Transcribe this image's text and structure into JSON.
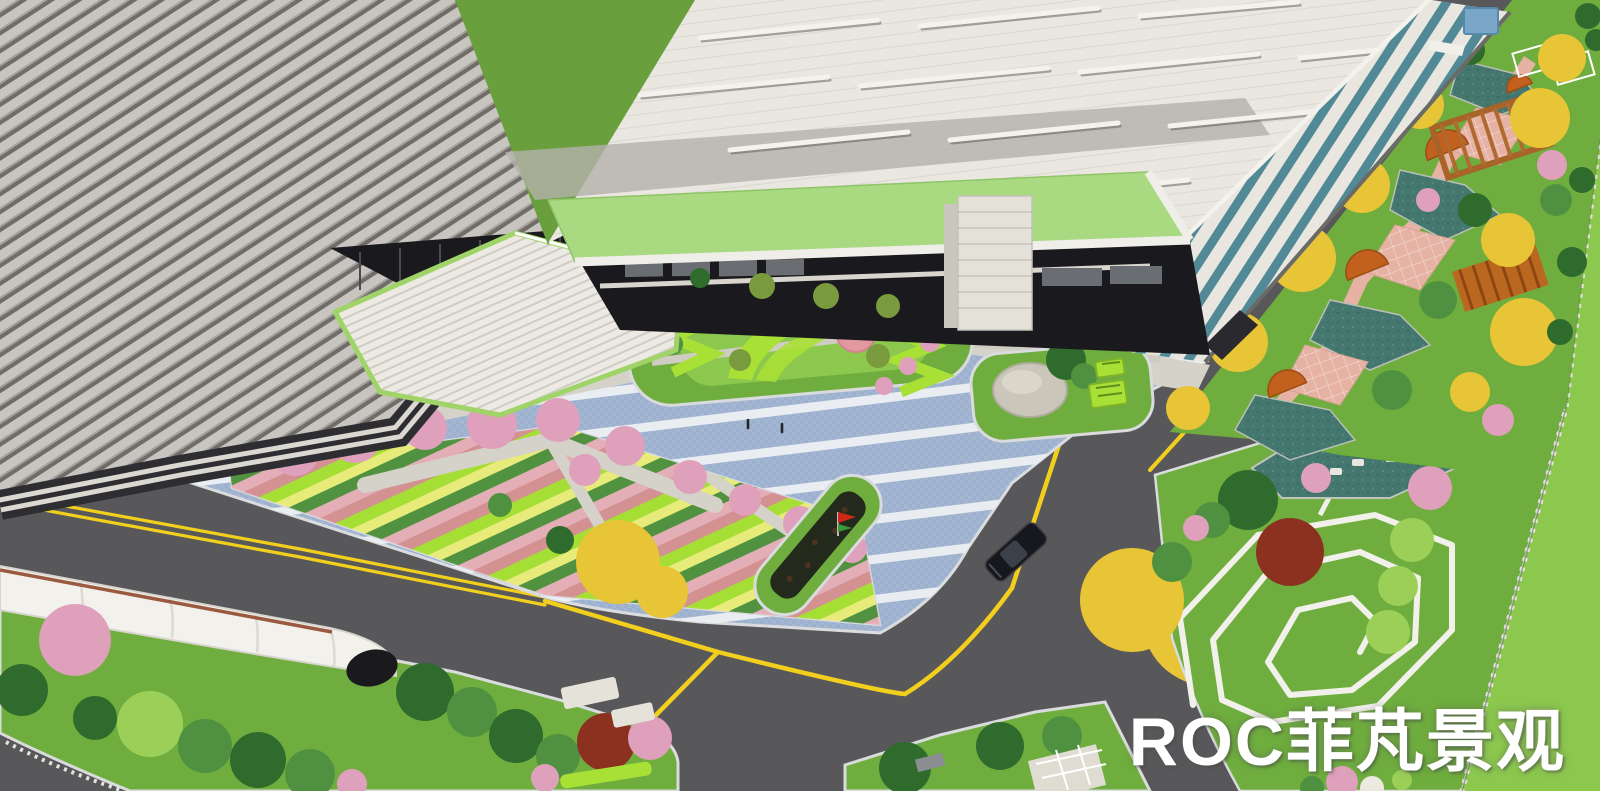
{
  "scene": {
    "type": "aerial-3d-landscape-rendering",
    "subject": "factory campus landscape design rendering with warehouses, entrance plaza, parking lot, roads and linear gardens"
  },
  "watermark": {
    "text": "ROC菲芃景观"
  },
  "palette": {
    "asphalt": "#58585b",
    "roadline": "#f2cf1d",
    "curb": "#d9dbdd",
    "paving": "#9db1cf",
    "paving_stripe": "#eef1f4",
    "walk_light": "#d5d2c9",
    "walk_stone": "#cfccc3",
    "lawn": "#6fae3e",
    "lawn_bright": "#8cc84e",
    "grass_dark": "#699f3c",
    "hedge_lime": "#a8e035",
    "hedge_yellow": "#ecee7c",
    "hedge_pink": "#e9aebc",
    "hedge_rose": "#d98f96",
    "tree_dgreen": "#2f6b2c",
    "tree_green": "#4f9140",
    "tree_lime": "#9ccf57",
    "tree_olive": "#7a9a3e",
    "tree_yellow": "#e8c437",
    "tree_pink": "#dfa0bc",
    "tree_red": "#8c3020",
    "rib_light": "#c8c5c0",
    "rib_mid": "#a5a29d",
    "rib_dark": "#706d68",
    "band_dark": "#2e2e32",
    "cornice": "#dbd8d1",
    "roof_white": "#eae7e0",
    "roof_shade": "#b4b1aa",
    "eave_white": "#f4f2ec",
    "wall_white": "#e9e6df",
    "win_teal": "#4a8492",
    "canopy_green": "#a9da81",
    "fascia": "#f0eee8",
    "arcade_dark": "#1a1a1e",
    "tower": "#e4e1d9",
    "stair_tread": "#eceae3",
    "stair_step": "#cfccc5",
    "stair_trim": "#a0d468",
    "stone": "#cac6b9",
    "pink_disc": "#e3989f",
    "pond_teal": "#44786f",
    "deck_orange": "#c2611d",
    "pergola": "#a86428",
    "pink_pave": "#e5b2a4",
    "fence": "#e6e4de",
    "canopy_white": "#f3f1ec",
    "bed_dark": "#232a1c",
    "flag_red": "#d02818",
    "flag_green": "#3a9a3a",
    "car_black": "#17181d",
    "utility_box_blue": "#7aa7c8",
    "watermark": "#ffffff"
  },
  "regions": [
    "ribbed-factory-building",
    "white-warehouse",
    "grand-staircase",
    "entrance-canopy",
    "entrance-tower",
    "central-plaza",
    "parking-lot",
    "central-garden-island",
    "boulder-island",
    "parking-flower-island",
    "diagonal-hedge-garden",
    "perimeter-road",
    "arched-shelter-lawn",
    "spiral-path-lawn",
    "linear-park",
    "pergola",
    "boundary-fence"
  ]
}
